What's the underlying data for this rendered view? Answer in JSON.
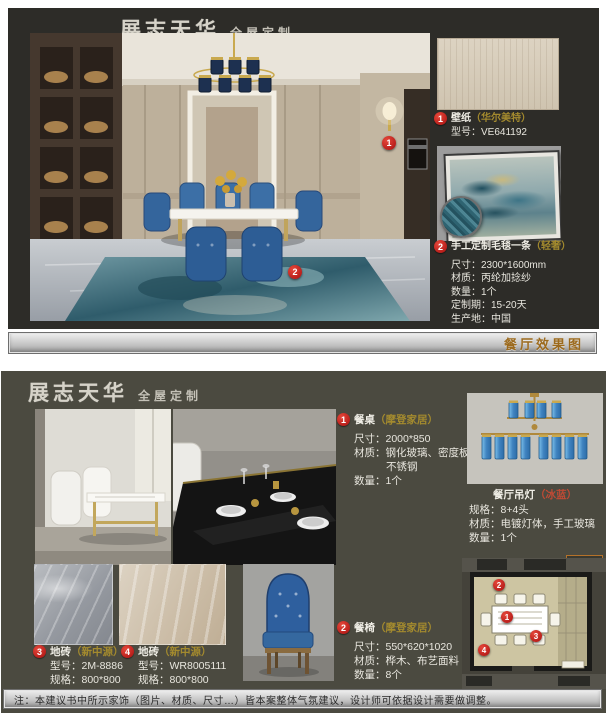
{
  "brand": {
    "logo": "展志天华",
    "tagline": "全屋定制"
  },
  "colors": {
    "accent_red": "#a80f0f",
    "brand_gold": "#a38a2e",
    "label_orange": "#9c6a1d",
    "panel_dark": "#2d2c28",
    "panel_olive": "#4b4a40"
  },
  "top_panel": {
    "photo_markers": [
      "1",
      "2"
    ],
    "wallpaper": {
      "num": "1",
      "title": "壁纸",
      "brand": "（华尔美特）",
      "model": "型号：VE641192"
    },
    "carpet": {
      "num": "2",
      "title": "手工定制毛毯一条",
      "brand": "（轻奢）",
      "lines": [
        "尺寸：2300*1600mm",
        "材质：丙纶加捻纱",
        "数量：1个",
        "定制期：15-20天",
        "生产地：中国"
      ]
    },
    "footer_label": "餐厅效果图"
  },
  "bottom_panel": {
    "table": {
      "num": "1",
      "title": "餐桌",
      "brand": "（摩登家居）",
      "lines": [
        "尺寸：2000*850",
        "材质：钢化玻璃、密度板、",
        "不锈钢",
        "数量：1个"
      ]
    },
    "chair": {
      "num": "2",
      "title": "餐椅",
      "brand": "（摩登家居）",
      "lines": [
        "尺寸：550*620*1020",
        "材质：桦木、布艺面料",
        "数量：8个"
      ]
    },
    "tile1": {
      "num": "3",
      "title": "地砖",
      "brand": "（新中源）",
      "lines": [
        "型号：2M-8886",
        "规格：800*800"
      ]
    },
    "tile2": {
      "num": "4",
      "title": "地砖",
      "brand": "（新中源）",
      "lines": [
        "型号：WR8005111",
        "规格：800*800"
      ]
    },
    "chandelier": {
      "title": "餐厅吊灯",
      "brand": "（冰蓝）",
      "lines": [
        "规格：8+4头",
        "材质：电镀灯体，手工玻璃",
        "数量：1个"
      ]
    },
    "plan": {
      "label": "餐厅",
      "markers": [
        "1",
        "2",
        "3",
        "4"
      ]
    }
  },
  "footer": {
    "note": "注：本建议书中所示家饰（图片、材质、尺寸…）皆本案整体气氛建议，设计师可依据设计需要做调整。"
  }
}
